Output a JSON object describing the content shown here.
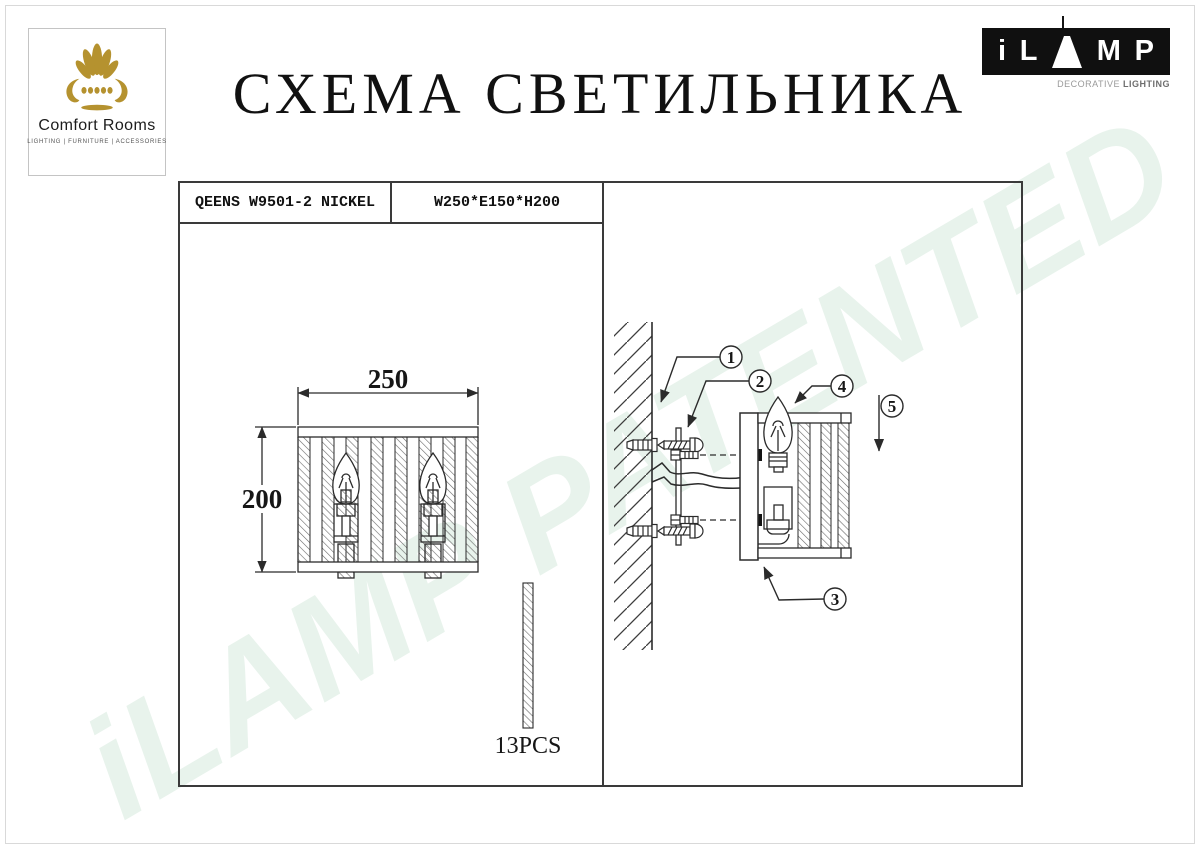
{
  "title": "СХЕМА СВЕТИЛЬНИКА",
  "watermark": {
    "text": "iLAMP PATENTED",
    "color": "#e8f3ec"
  },
  "page": {
    "background": "#ffffff",
    "frame_color": "#d9d9d9",
    "line_color": "#2b2b2b",
    "hatch_color": "#6a6a6a"
  },
  "logo_comfort_rooms": {
    "name": "Comfort Rooms",
    "tagline": "LIGHTING  |  FURNITURE  |  ACCESSORIES",
    "icon_color": "#b5922f"
  },
  "logo_ilamp": {
    "letter_i": "i",
    "letter_l": "L",
    "letter_m": "M",
    "letter_p": "P",
    "subtitle_light": "DECORATIVE",
    "subtitle_bold": "LIGHTING",
    "bg": "#101010"
  },
  "spec_table": {
    "model": "QEENS W9501-2 NICKEL",
    "dimensions": "W250*E150*H200"
  },
  "front_view": {
    "width_label": "250",
    "height_label": "200",
    "pieces_label": "13PCS"
  },
  "side_view": {
    "callouts": [
      "1",
      "2",
      "3",
      "4",
      "5"
    ]
  }
}
